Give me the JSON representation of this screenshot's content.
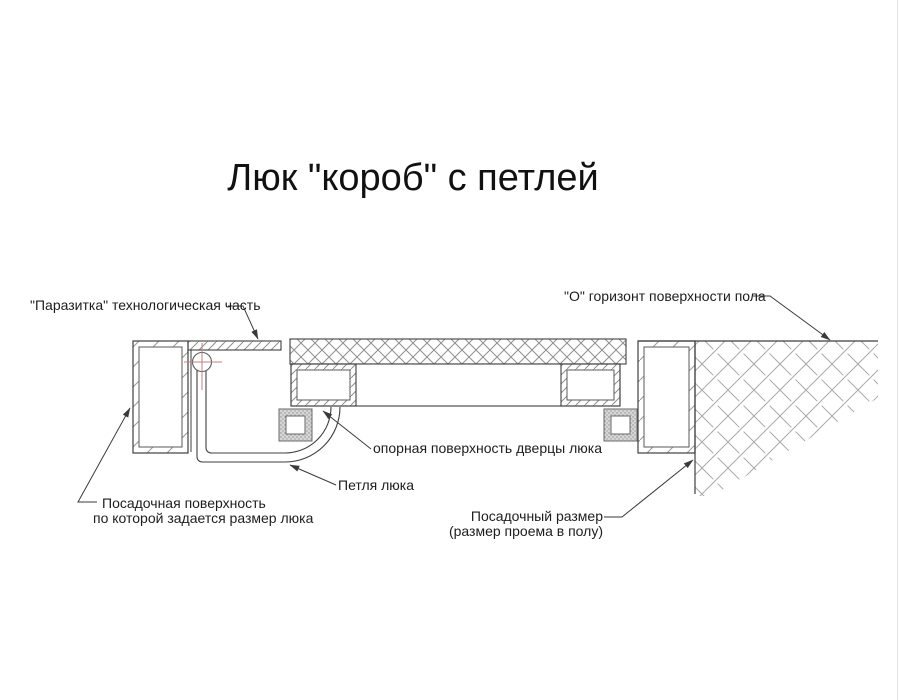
{
  "title": "Люк \"короб\" с петлей",
  "labels": {
    "parasitka": "\"Паразитка\" технологическая часть",
    "floor_horizon": "\"О\" горизонт поверхности пола",
    "support_surface": "опорная поверхность дверцы люка",
    "hinge": "Петля люка",
    "seating_surface_line1": "Посадочная поверхность",
    "seating_surface_line2": "по которой задается размер люка",
    "seating_size_line1": "Посадочный размер",
    "seating_size_line2": "(размер проема в полу)"
  },
  "colors": {
    "line": "#3f3f3f",
    "hatch": "#9a9a9a",
    "hinge_axis_cross": "#bd8282",
    "background": "#ffffff"
  }
}
